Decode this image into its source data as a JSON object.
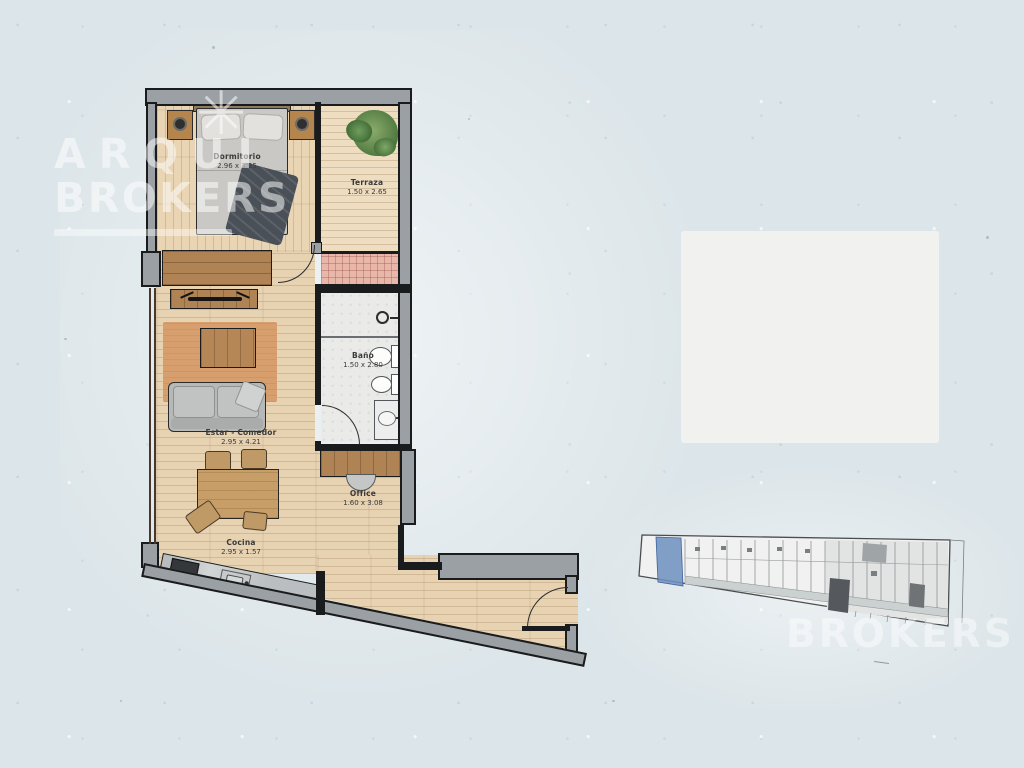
{
  "watermarks": {
    "top": {
      "line1": "ARQUI",
      "star": "✳",
      "line2": "BROKERS"
    },
    "bottom": {
      "text": "BROKERS"
    }
  },
  "rooms": [
    {
      "name": "Dormitorio",
      "dimensions": "2.96 x 3.25"
    },
    {
      "name": "Terraza",
      "dimensions": "1.50 x 2.65"
    },
    {
      "name": "Baño",
      "dimensions": "1.50 x 2.80"
    },
    {
      "name": "Estar - Comedor",
      "dimensions": "2.95 x 4.21"
    },
    {
      "name": "Office",
      "dimensions": "1.60 x 3.08"
    },
    {
      "name": "Cocina",
      "dimensions": "2.95 x 1.57"
    }
  ],
  "keyplan": {
    "highlight_color": "#6d8fbf"
  },
  "colors": {
    "background": "#dce5e9",
    "wall": "#9aa0a3",
    "wood_floor": "#e7d2b2",
    "terrace_tile": "#e9b7aa",
    "keyplan_highlight": "#6d8fbf"
  }
}
